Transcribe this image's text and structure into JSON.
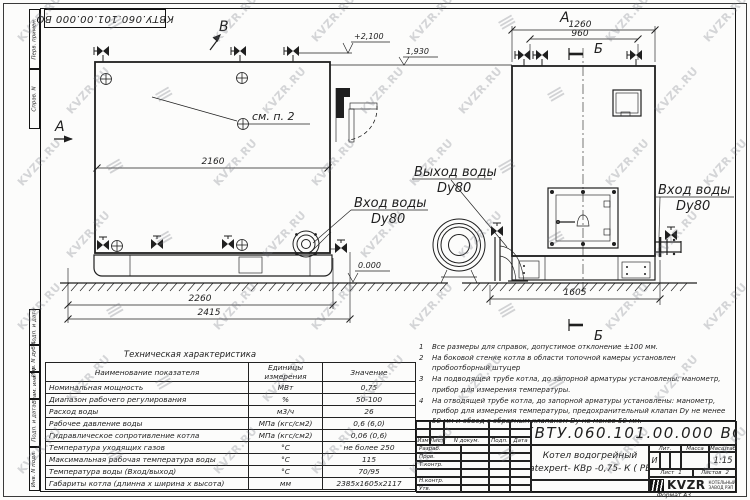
{
  "sheet": {
    "designation": "КВТУ.060.101.00.000  ВО",
    "format": "Формат  А3",
    "watermark": {
      "text": "KVZR.RU",
      "glyph": "≡"
    }
  },
  "margin_labels": [
    "Перв. примен.",
    "Справ. N",
    "Подп. и дата",
    "Инв. N дубл.",
    "Взам. инв. N",
    "Подп. и дата",
    "Инв. N подл."
  ],
  "drawing": {
    "section_a": "А",
    "arrow_b": "В",
    "section_b": "Б",
    "see_item": "см. п. 2",
    "elev_top": "+2,100",
    "elev_mid": "1,930",
    "elev_zero": "0.000",
    "dim_body_length": "2160",
    "dim_base_length": "2260",
    "dim_overall_length": "2415",
    "dim_front_width": "1260",
    "dim_valve_span": "960",
    "dim_front_depth": "1605",
    "inlet_label": "Вход воды",
    "outlet_label": "Выход воды",
    "dy80": "Dy80"
  },
  "tech_table": {
    "title": "Техническая характеристика",
    "columns": {
      "name": "Наименование показателя",
      "units": "Единицы измерения",
      "value": "Значение"
    },
    "rows": [
      {
        "name": "Номинальная мощность",
        "units": "МВт",
        "value": "0,75"
      },
      {
        "name": "Диапазон рабочего регулирования",
        "units": "%",
        "value": "50-100"
      },
      {
        "name": "Расход воды",
        "units": "м3/ч",
        "value": "26"
      },
      {
        "name": "Рабочее давление воды",
        "units": "МПа (кгс/см2)",
        "value": "0,6 (6,0)"
      },
      {
        "name": "Гидравлическое сопротивление котла",
        "units": "МПа (кгс/см2)",
        "value": "0,06 (0,6)"
      },
      {
        "name": "Температура уходящих газов",
        "units": "°С",
        "value": "не более 250"
      },
      {
        "name": "Максимальная рабочая температура воды",
        "units": "°С",
        "value": "115"
      },
      {
        "name": "Температура воды (Вход/выход)",
        "units": "°С",
        "value": "70/95"
      },
      {
        "name": "Габариты котла (длинна х ширина х высота)",
        "units": "мм",
        "value": "2385х1605х2117"
      }
    ]
  },
  "notes": [
    {
      "num": "1",
      "text": "Все размеры для справок, допустимое отклонение ±100 мм."
    },
    {
      "num": "2",
      "text": "На боковой стенке котла в области топочной камеры установлен пробоотборный штуцер"
    },
    {
      "num": "3",
      "text": "На подводящей трубе котла, до запорной арматуры установлены: манометр, прибор для измерения температуры."
    },
    {
      "num": "4",
      "text": "На отводящей трубе котла, до запорной арматуры установлены: манометр, прибор для измерения температуры, предохранительный клапан Dy не менее 50 мм и обвод с обратным клапаном Dy не менее 50 мм."
    }
  ],
  "title_block": {
    "designation": "КВТУ.060.101.00.000  ВО",
    "header": [
      "Изм",
      "Лист",
      "N докум.",
      "Подп.",
      "Дата"
    ],
    "row_labels": [
      "Разраб.",
      "Пров.",
      "Т.контр.",
      "",
      "Н.контр.",
      "Утв."
    ],
    "name_line1": "Котел водогрейный",
    "name_line2": "Heatexpert- КВр -0,75- К ( РВР )",
    "lit_label": "Лит.",
    "lit_value": "И",
    "mass_label": "Масса",
    "scale_label": "Масштаб",
    "scale_value": "1:15",
    "sheet_label": "Лист",
    "sheet_value": "1",
    "sheets_label": "Листов",
    "sheets_value": "2",
    "brand": "KVZR",
    "brand_line1": "КОТЕЛЬНЫЙ",
    "brand_line2": "ЗАВОД РЭП"
  }
}
